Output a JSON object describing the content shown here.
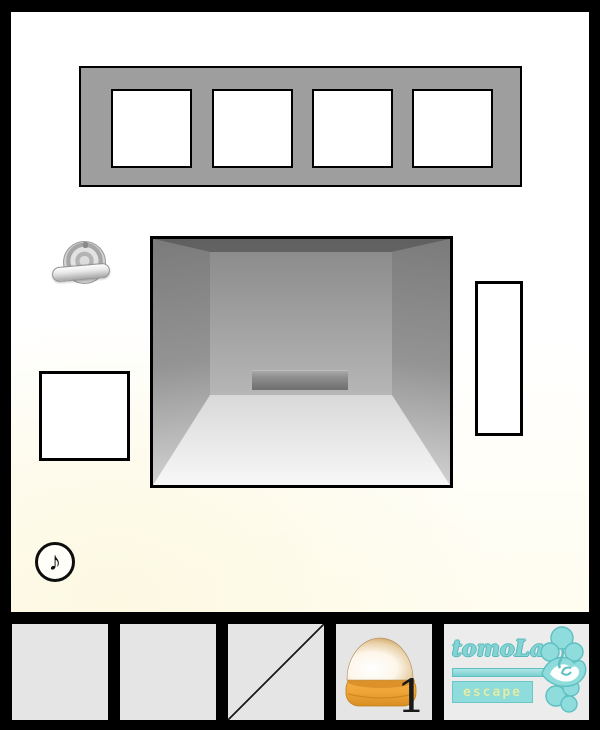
{
  "game": {
    "brand": {
      "title": "tomoLa",
      "subtitle": "escape"
    }
  },
  "scene": {
    "name": "wall-with-alcove",
    "elements": {
      "frame_panel": {
        "squares": 4,
        "color": "#9e9e9e"
      },
      "valve_knob": {
        "state": "horizontal"
      },
      "alcove": {
        "ledge": true
      },
      "left_square": {
        "state": "blank"
      },
      "right_rect": {
        "state": "blank"
      }
    },
    "background_tint": "#fffdf0"
  },
  "audio": {
    "glyph": "♪",
    "state": "on"
  },
  "inventory": {
    "slots": [
      {
        "state": "empty"
      },
      {
        "state": "empty"
      },
      {
        "state": "crossed-out"
      },
      {
        "state": "filled",
        "item": "dome-lamp",
        "count": "1"
      },
      {
        "state": "brand-logo"
      }
    ]
  },
  "colors": {
    "frame_black": "#000000",
    "panel_gray": "#9e9e9e",
    "slot_gray": "#e5e5e5",
    "accent_teal": "#8edcdc",
    "item_orange": "#f0a23c",
    "cream_tint": "#fffdf0"
  }
}
